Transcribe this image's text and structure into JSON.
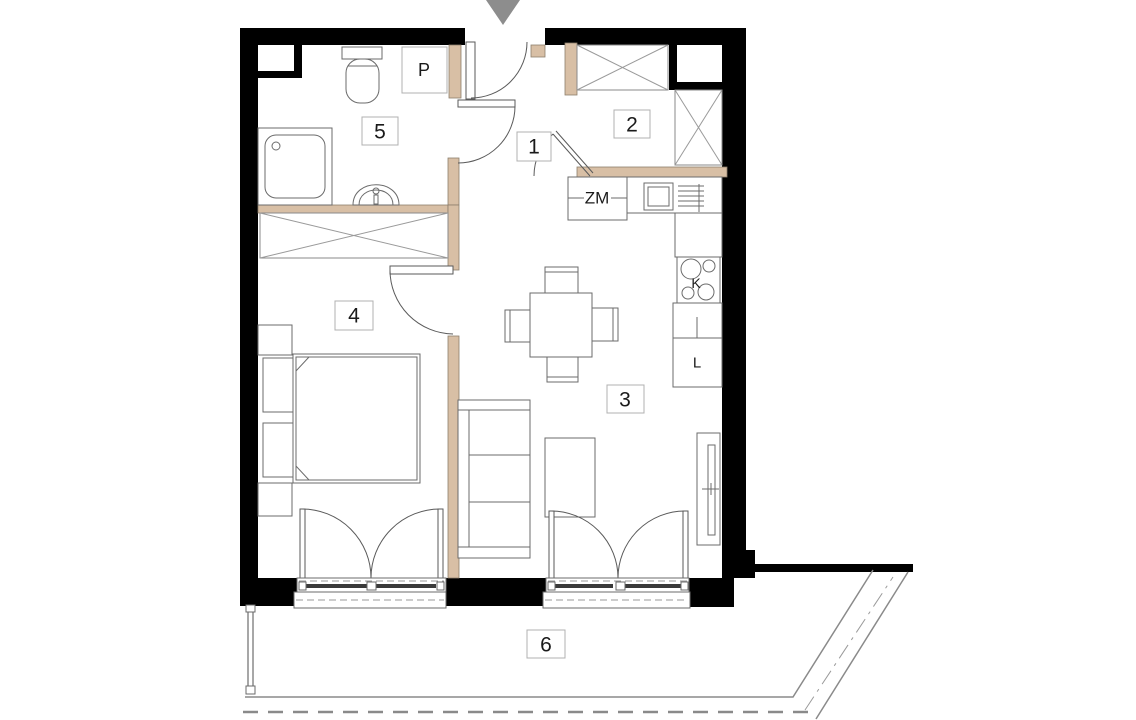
{
  "title": "Apartment floor plan",
  "colors": {
    "wall": "#000000",
    "jamb": "#d8bfa5",
    "jamb_border": "#8d7f6d",
    "line": "#6b6b6b",
    "entry_arrow": "#8d8d8d"
  },
  "rooms": [
    {
      "id": "room-1",
      "label": "1"
    },
    {
      "id": "room-2",
      "label": "2"
    },
    {
      "id": "room-3",
      "label": "3"
    },
    {
      "id": "room-4",
      "label": "4"
    },
    {
      "id": "room-5",
      "label": "5"
    },
    {
      "id": "room-6",
      "label": "6"
    }
  ],
  "fixtures": {
    "washing_machine": "P",
    "dishwasher": "ZM",
    "cooktop": "K",
    "fridge": "L"
  }
}
